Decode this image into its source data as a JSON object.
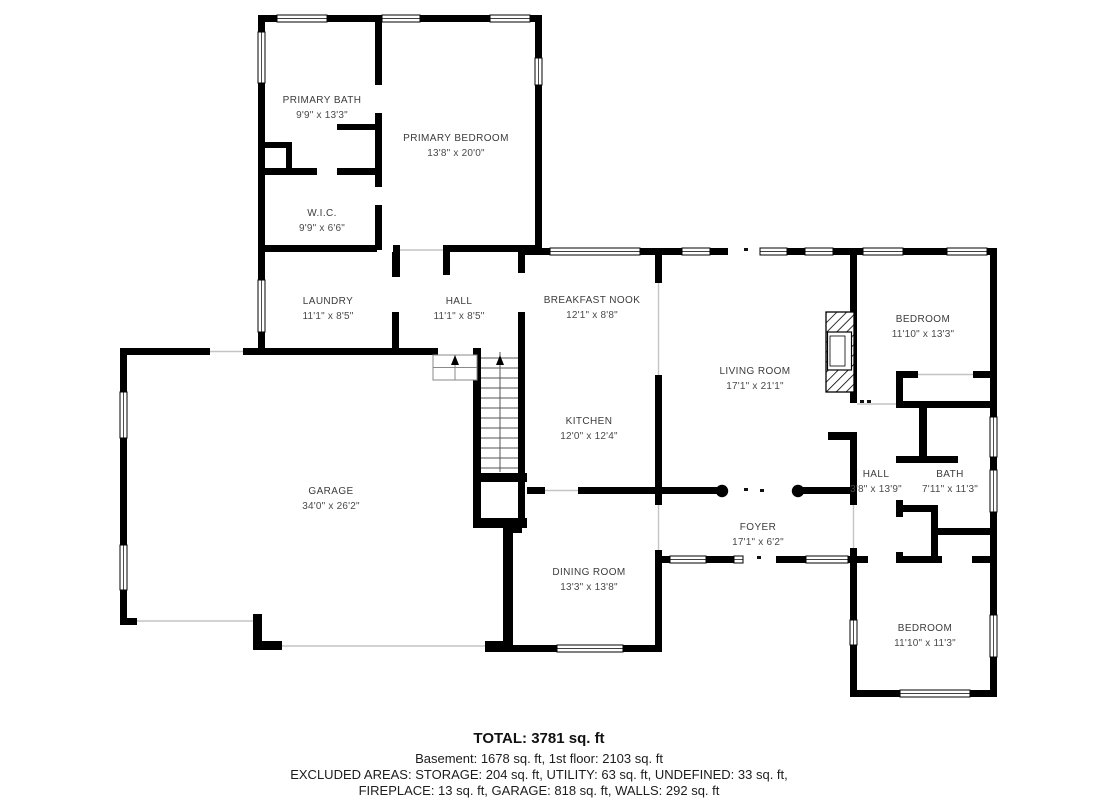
{
  "plan": {
    "type": "floor-plan",
    "colors": {
      "walls": "#000000",
      "background": "#ffffff",
      "labels": "#3c3c3c"
    }
  },
  "rooms": [
    {
      "id": "primary-bath",
      "name": "PRIMARY BATH",
      "dims": "9'9\" x 13'3\""
    },
    {
      "id": "primary-bedroom",
      "name": "PRIMARY BEDROOM",
      "dims": "13'8\" x 20'0\""
    },
    {
      "id": "wic",
      "name": "W.I.C.",
      "dims": "9'9\" x 6'6\""
    },
    {
      "id": "laundry",
      "name": "LAUNDRY",
      "dims": "11'1\" x 8'5\""
    },
    {
      "id": "hall-upper",
      "name": "HALL",
      "dims": "11'1\" x 8'5\""
    },
    {
      "id": "breakfast-nook",
      "name": "BREAKFAST NOOK",
      "dims": "12'1\" x 8'8\""
    },
    {
      "id": "living-room",
      "name": "LIVING ROOM",
      "dims": "17'1\" x 21'1\""
    },
    {
      "id": "bedroom-upper",
      "name": "BEDROOM",
      "dims": "11'10\" x 13'3\""
    },
    {
      "id": "kitchen",
      "name": "KITCHEN",
      "dims": "12'0\" x 12'4\""
    },
    {
      "id": "garage",
      "name": "GARAGE",
      "dims": "34'0\" x 26'2\""
    },
    {
      "id": "hall-right",
      "name": "HALL",
      "dims": "3'8\" x 13'9\""
    },
    {
      "id": "bath",
      "name": "BATH",
      "dims": "7'11\" x 11'3\""
    },
    {
      "id": "foyer",
      "name": "FOYER",
      "dims": "17'1\" x 6'2\""
    },
    {
      "id": "dining-room",
      "name": "DINING ROOM",
      "dims": "13'3\" x 13'8\""
    },
    {
      "id": "bedroom-lower",
      "name": "BEDROOM",
      "dims": "11'10\" x 11'3\""
    }
  ],
  "summary": {
    "total": "TOTAL: 3781 sq. ft",
    "floors": "Basement: 1678 sq. ft, 1st floor: 2103 sq. ft",
    "excluded_line1": "EXCLUDED AREAS: STORAGE: 204 sq. ft, UTILITY: 63 sq. ft, UNDEFINED: 33 sq. ft,",
    "excluded_line2": "FIREPLACE: 13 sq. ft, GARAGE: 818 sq. ft, WALLS: 292 sq. ft",
    "values": {
      "total_sqft": 3781,
      "basement_sqft": 1678,
      "first_floor_sqft": 2103,
      "storage_sqft": 204,
      "utility_sqft": 63,
      "undefined_sqft": 33,
      "fireplace_sqft": 13,
      "garage_sqft": 818,
      "walls_sqft": 292
    }
  }
}
